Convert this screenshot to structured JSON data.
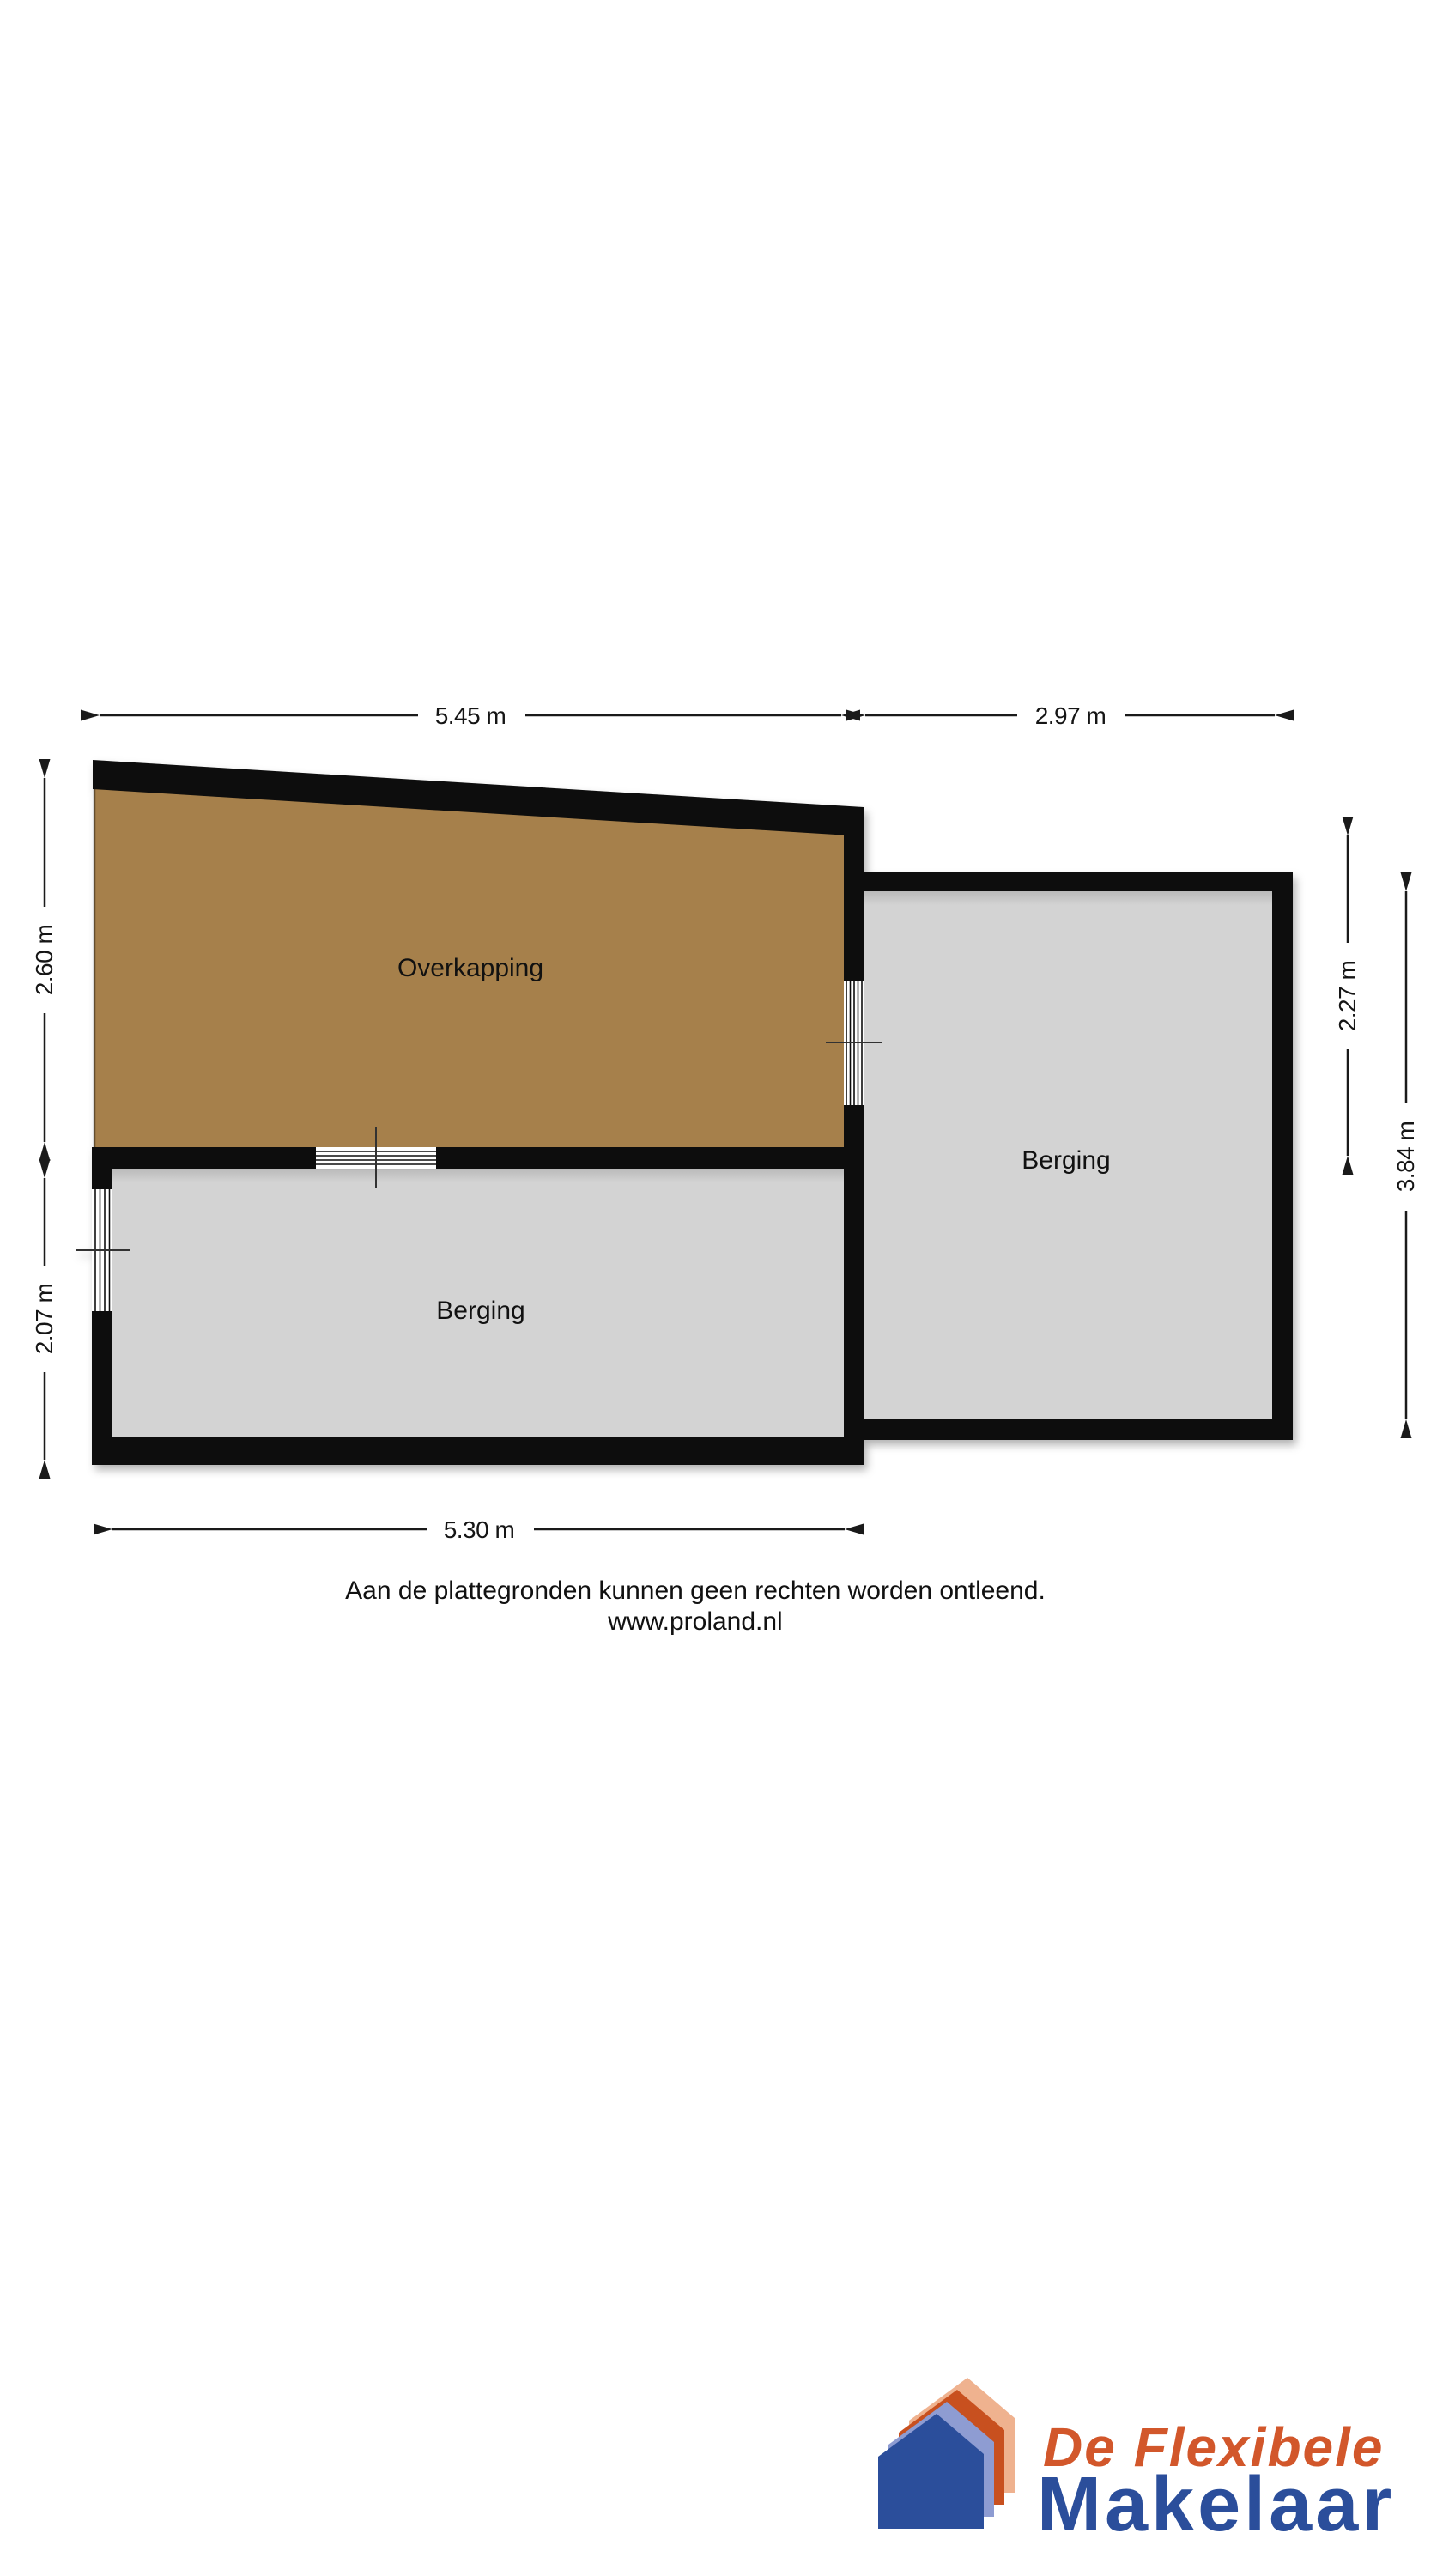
{
  "page": {
    "background": "#FFFFFF"
  },
  "floorplan": {
    "rooms": [
      {
        "label": "Overkapping",
        "fill": "#A6804C"
      },
      {
        "label": "Berging",
        "fill": "#D3D3D3"
      },
      {
        "label": "Berging",
        "fill": "#D3D3D3"
      }
    ],
    "dimensions": {
      "top_left": "5.45 m",
      "top_right": "2.97 m",
      "left_upper": "2.60 m",
      "left_lower": "2.07 m",
      "right_inner": "2.27 m",
      "right_outer": "3.84 m",
      "bottom": "5.30 m"
    },
    "wall_color": "#0B0B0B",
    "dimension_color": "#1A1A1A"
  },
  "footer": {
    "disclaimer": "Aan de plattegronden kunnen geen rechten worden ontleend.",
    "website": "www.proland.nl"
  },
  "logo": {
    "name_line1": "De Flexibele",
    "name_line2": "Makelaar",
    "house_layer_colors": [
      "#EFB28F",
      "#C8501F",
      "#8E9CD2",
      "#2B4E9B"
    ],
    "text_color_line1": "#D2572B",
    "text_color_line2": "#2B4E9B"
  }
}
